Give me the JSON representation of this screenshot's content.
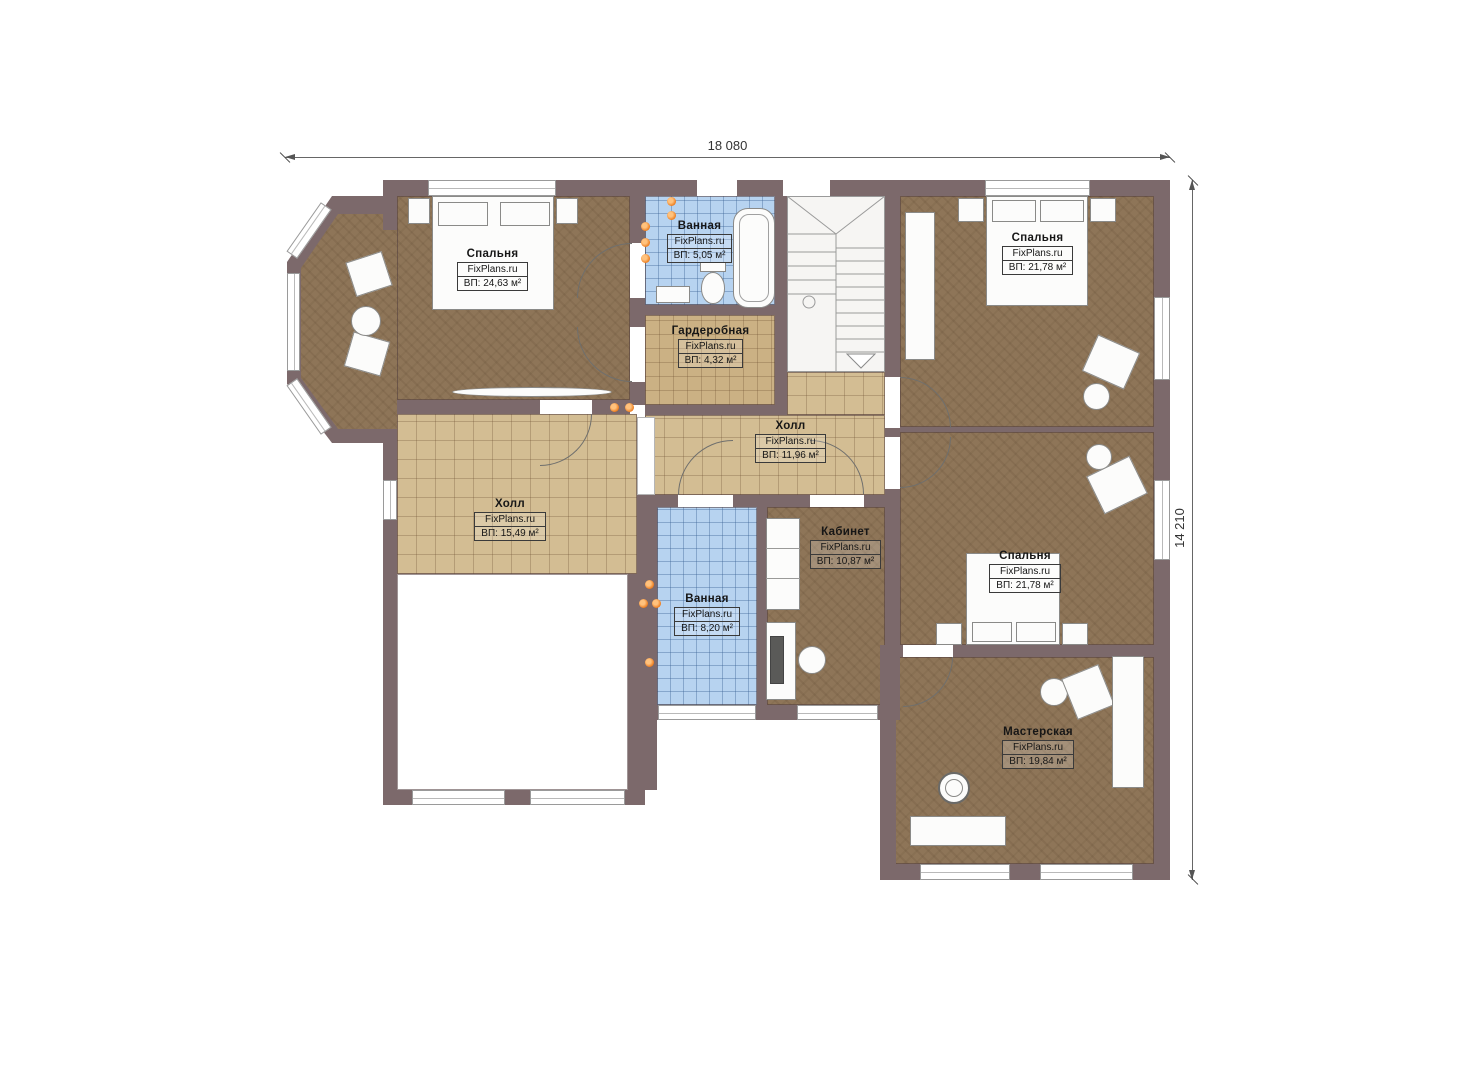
{
  "plan": {
    "title": "Floor plan",
    "dimensions": {
      "width": "18 080",
      "height": "14 210"
    },
    "brand": "FixPlans.ru",
    "colors": {
      "wall": "#7C696B",
      "bedroom_floor": "#8E7558",
      "hall_tile": "#D3BD93",
      "wardrobe_tile": "#CCB184",
      "bath_tile": "#B7D3F0",
      "lamp_accent": "#ED7D1F"
    },
    "rooms": [
      {
        "id": "bedroom-top-left",
        "name": "Спальня",
        "watermark": "FixPlans.ru",
        "area": "ВП: 24,63 м²"
      },
      {
        "id": "bathroom-top",
        "name": "Ванная",
        "watermark": "FixPlans.ru",
        "area": "ВП: 5,05 м²"
      },
      {
        "id": "wardrobe",
        "name": "Гардеробная",
        "watermark": "FixPlans.ru",
        "area": "ВП: 4,32 м²"
      },
      {
        "id": "bedroom-top-right",
        "name": "Спальня",
        "watermark": "FixPlans.ru",
        "area": "ВП: 21,78 м²"
      },
      {
        "id": "hall-center",
        "name": "Холл",
        "watermark": "FixPlans.ru",
        "area": "ВП: 11,96 м²"
      },
      {
        "id": "hall-left",
        "name": "Холл",
        "watermark": "FixPlans.ru",
        "area": "ВП: 15,49 м²"
      },
      {
        "id": "bathroom-center",
        "name": "Ванная",
        "watermark": "FixPlans.ru",
        "area": "ВП: 8,20 м²"
      },
      {
        "id": "office",
        "name": "Кабинет",
        "watermark": "FixPlans.ru",
        "area": "ВП: 10,87 м²"
      },
      {
        "id": "bedroom-middle",
        "name": "Спальня",
        "watermark": "FixPlans.ru",
        "area": "ВП: 21,78 м²"
      },
      {
        "id": "workshop",
        "name": "Мастерская",
        "watermark": "FixPlans.ru",
        "area": "ВП: 19,84 м²"
      }
    ]
  }
}
